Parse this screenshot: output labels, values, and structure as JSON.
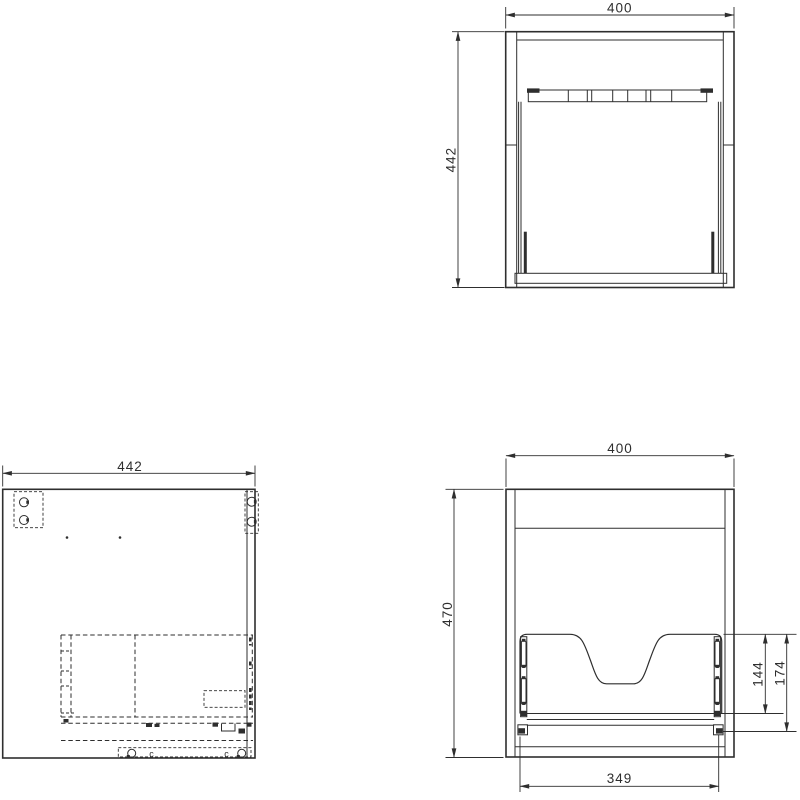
{
  "colors": {
    "line": "#2e2e2e",
    "background": "#ffffff"
  },
  "views": {
    "top_view": {
      "width_label": "400",
      "depth_label": "442"
    },
    "side_view": {
      "depth_label": "442",
      "clip_labels": [
        "c",
        "c"
      ]
    },
    "front_view": {
      "width_label": "400",
      "height_label": "470",
      "basin_cutout_height_label": "144",
      "drawer_back_height_label": "174",
      "drawer_width_label": "349"
    }
  }
}
